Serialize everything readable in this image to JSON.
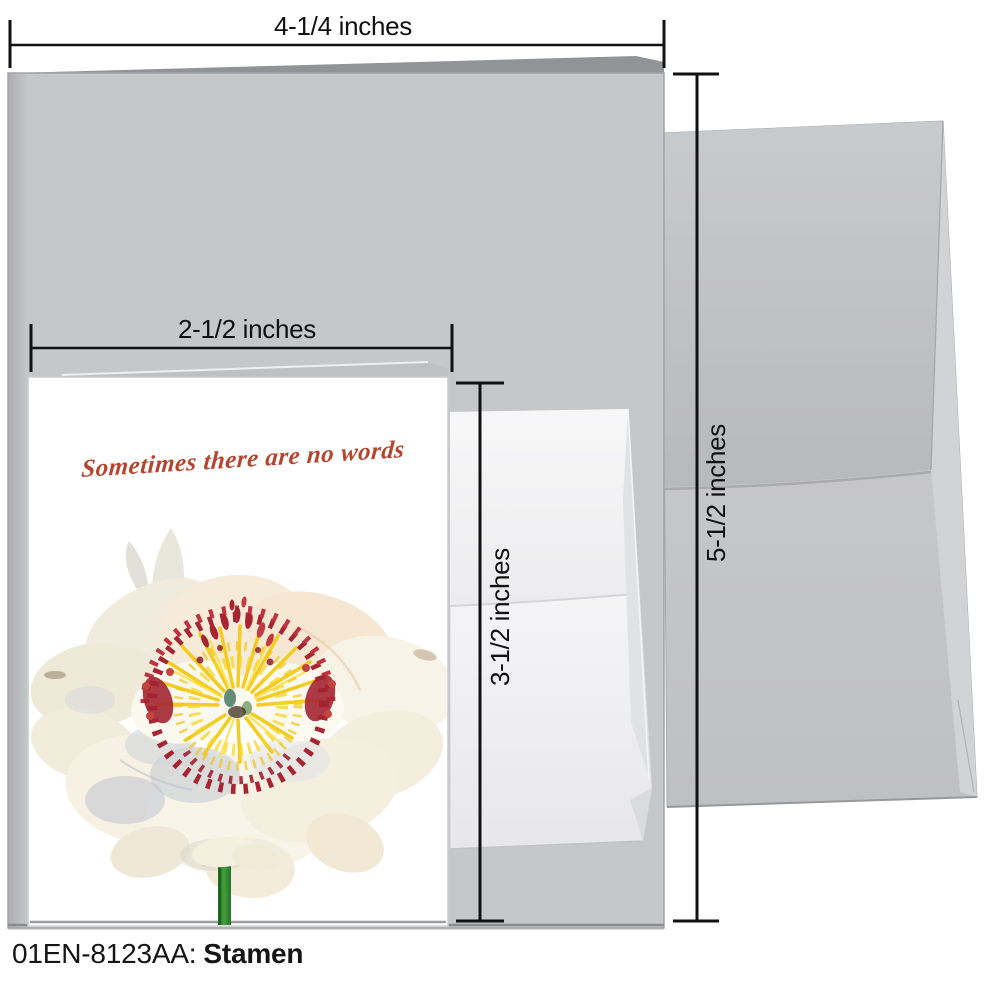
{
  "annotations": {
    "width_large": "4-1/4 inches",
    "width_small": "2-1/2 inches",
    "height_small": "3-1/2 inches",
    "height_large": "5-1/2 inches"
  },
  "card": {
    "message": "Sometimes there are no words"
  },
  "caption": {
    "code": "01EN-8123AA:",
    "name": "Stamen"
  },
  "colors": {
    "script_accent": "#b5452f",
    "dimension_line": "#111111",
    "card_gray": "#c6c7c9",
    "envelope_gray": "#c8c9cb",
    "stem_green": "#2e8b2e",
    "stamen_yellow": "#f2cc1e",
    "anther_red": "#a52531"
  }
}
